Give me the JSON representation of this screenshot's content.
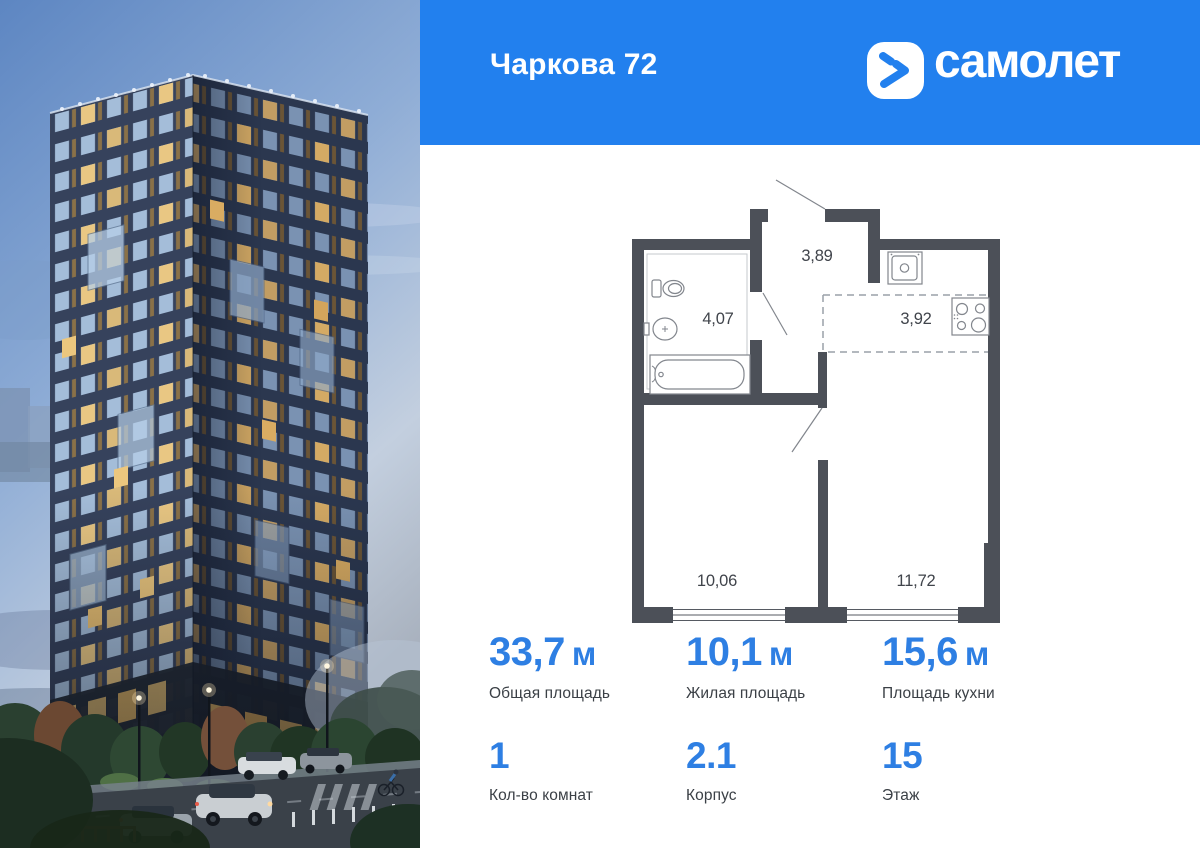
{
  "header": {
    "title": "Чаркова 72",
    "brand": "самолет"
  },
  "plan": {
    "rooms": [
      {
        "name": "hallway",
        "area": "3,89"
      },
      {
        "name": "bathroom",
        "area": "4,07"
      },
      {
        "name": "kitchen",
        "area": "3,92"
      },
      {
        "name": "bedroom",
        "area": "10,06"
      },
      {
        "name": "living",
        "area": "11,72"
      }
    ]
  },
  "stats": {
    "primary": [
      {
        "value": "33,7",
        "unit": "м",
        "label": "Общая площадь"
      },
      {
        "value": "10,1",
        "unit": "м",
        "label": "Жилая площадь"
      },
      {
        "value": "15,6",
        "unit": "м",
        "label": "Площадь кухни"
      }
    ],
    "secondary": [
      {
        "value": "1",
        "label": "Кол-во комнат"
      },
      {
        "value": "2.1",
        "label": "Корпус"
      },
      {
        "value": "15",
        "label": "Этаж"
      }
    ]
  },
  "colors": {
    "header_blue": "#2280ee",
    "value_blue": "#2e7fe3",
    "plan_wall": "#4c5058"
  }
}
